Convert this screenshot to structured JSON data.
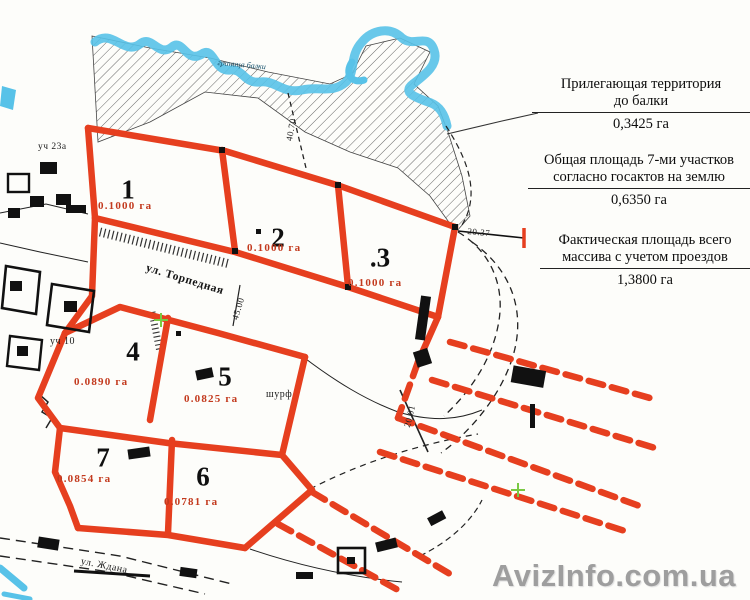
{
  "plots": [
    {
      "number": "1",
      "area": "0.1000 га"
    },
    {
      "number": "2",
      "area": "0.1000 га"
    },
    {
      "number": ".3",
      "area": "0.1000 га"
    },
    {
      "number": "4",
      "area": "0.0890 га"
    },
    {
      "number": "5",
      "area": "0.0825 га"
    },
    {
      "number": "6",
      "area": "0.0781 га"
    },
    {
      "number": "7",
      "area": "0.0854 га"
    }
  ],
  "annotations": [
    {
      "lines": [
        "Прилегающая территория",
        "до балки"
      ],
      "value": "0,3425 га"
    },
    {
      "lines": [
        "Общая площадь 7-ми участков",
        "согласно госактов на землю"
      ],
      "value": "0,6350 га"
    },
    {
      "lines": [
        "Фактическая площадь всего",
        "массива с учетом проездов"
      ],
      "value": "1,3800 га"
    }
  ],
  "labels": {
    "street_main": "ул. Торпедная",
    "street_bottom": "ул. Ждана",
    "plot_23a": "уч 23а",
    "plot_10": "уч 10",
    "shurf": "шурф",
    "stream": "граница балки"
  },
  "measurements": {
    "m2037": "20.37",
    "m4500": "45.00",
    "m4070": "40.70",
    "m2001": "20.01"
  },
  "watermark": "AvizInfo.com.ua",
  "colors": {
    "boundary_red": "#e63f1f",
    "water_blue": "#58c2e8",
    "area_text_red": "#c33a1e",
    "watermark_gray": "#9e9e9e",
    "green_mark": "#7ac943"
  }
}
